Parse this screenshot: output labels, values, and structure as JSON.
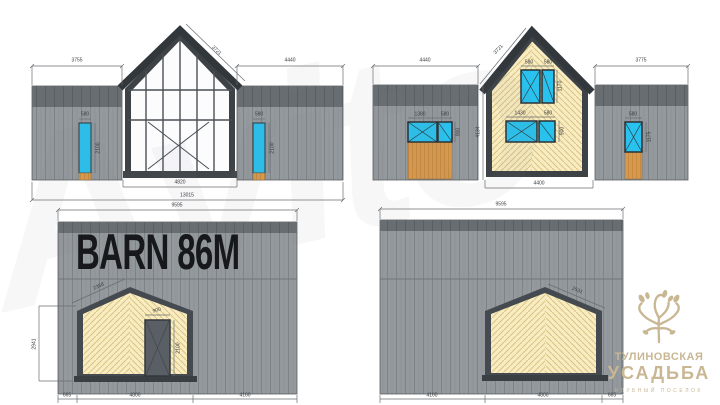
{
  "watermark": "Avito",
  "title_on_wall": "BARN 86M",
  "logo": {
    "line1": "ТУЛИНОВСКАЯ",
    "line2": "УСАДЬБА",
    "line3": "клубный поселок"
  },
  "colors": {
    "wall_gray": "#94999d",
    "wall_band_dark": "#6a6f73",
    "frame_dark": "#3d4247",
    "window_cyan": "#29c1ed",
    "wood_orange": "#d9994d",
    "cladding_yellow": "#f8ecc0",
    "logo_beige": "#c9b794",
    "dim_text": "#3a3d41"
  },
  "elevations": {
    "front": {
      "label": "front-elevation",
      "dims": {
        "left_wall": "3755",
        "right_wall": "4440",
        "roof_slope": "3721",
        "glazing_width": "4820",
        "total_width": "13015",
        "left_door_width": "580",
        "left_door_height": "2100",
        "right_door_width": "580",
        "right_door_height": "2100"
      }
    },
    "rear": {
      "label": "rear-elevation",
      "dims": {
        "left_wall": "4440",
        "right_wall": "3775",
        "roof_slope": "3721",
        "eave_height": "4134",
        "gable_width": "4400",
        "wing_window_width": "1380",
        "wing_window_small": "580",
        "wing_window_height": "900",
        "right_window_width": "580",
        "right_window_height": "1175",
        "upper_window_a": "580",
        "upper_window_b": "580",
        "upper_window_height": "1170",
        "lower_window_a": "1430",
        "lower_window_b": "580",
        "lower_window_height": "900"
      }
    },
    "side_left": {
      "label": "side-elevation-left",
      "dims": {
        "length": "9595",
        "wall_height": "2941",
        "porch_slope": "2358",
        "door_width": "900",
        "door_height": "2100",
        "seg_left": "665",
        "seg_mid": "4800",
        "seg_right": "4160"
      }
    },
    "side_right": {
      "label": "side-elevation-right",
      "dims": {
        "length": "9595",
        "porch_slope": "2531",
        "seg_left": "4160",
        "seg_mid": "4800",
        "seg_right": "665"
      }
    }
  }
}
